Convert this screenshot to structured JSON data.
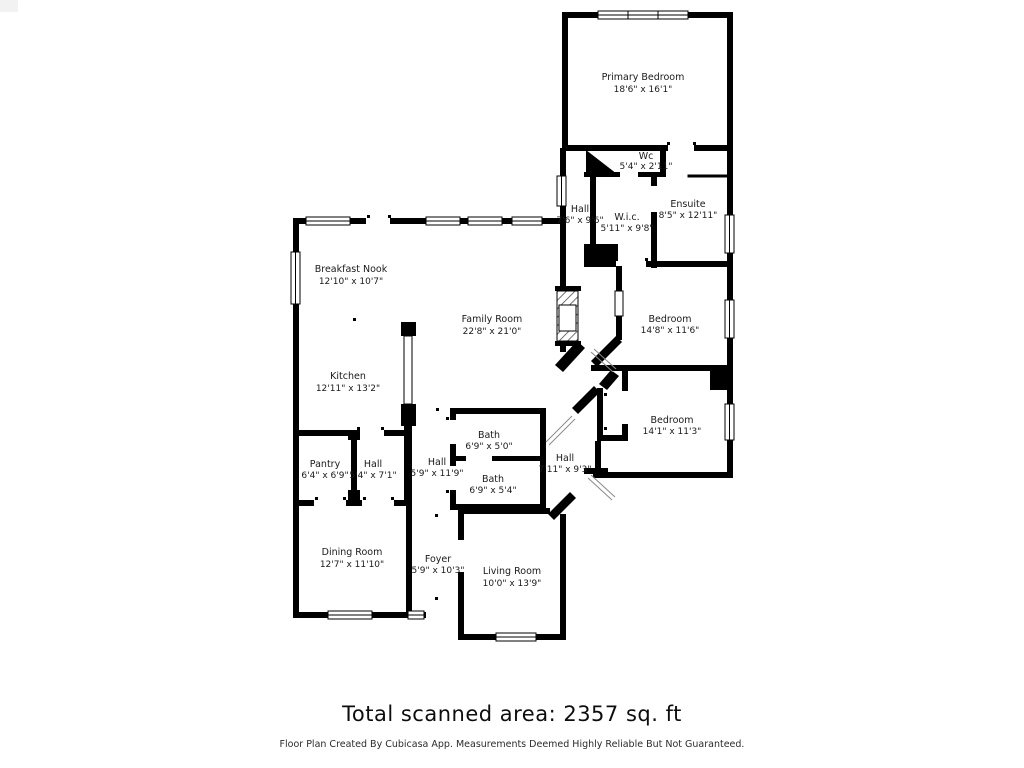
{
  "footer": {
    "total_area": "Total scanned area: 2357 sq. ft",
    "disclaimer": "Floor Plan Created By Cubicasa App. Measurements Deemed Highly Reliable But Not Guaranteed."
  },
  "rooms": [
    {
      "name": "Primary Bedroom",
      "dims": "18'6\" x 16'1\""
    },
    {
      "name": "Wc",
      "dims": "5'4\" x 2'11\""
    },
    {
      "name": "Hall",
      "dims": "7'6\" x 9'6\""
    },
    {
      "name": "W.i.c.",
      "dims": "5'11\" x 9'8\""
    },
    {
      "name": "Ensuite",
      "dims": "8'5\" x 12'11\""
    },
    {
      "name": "Breakfast Nook",
      "dims": "12'10\" x 10'7\""
    },
    {
      "name": "Family Room",
      "dims": "22'8\" x 21'0\""
    },
    {
      "name": "Kitchen",
      "dims": "12'11\" x 13'2\""
    },
    {
      "name": "Bedroom",
      "dims": "14'8\" x 11'6\""
    },
    {
      "name": "Bedroom",
      "dims": "14'1\" x 11'3\""
    },
    {
      "name": "Bath",
      "dims": "6'9\" x 5'0\""
    },
    {
      "name": "Bath",
      "dims": "6'9\" x 5'4\""
    },
    {
      "name": "Hall",
      "dims": "5'9\" x 11'9\""
    },
    {
      "name": "Hall",
      "dims": "7'11\" x 9'3\""
    },
    {
      "name": "Pantry",
      "dims": "6'4\" x 6'9\""
    },
    {
      "name": "Hall",
      "dims": "5'4\" x 7'1\""
    },
    {
      "name": "Dining Room",
      "dims": "12'7\" x 11'10\""
    },
    {
      "name": "Foyer",
      "dims": "5'9\" x 10'3\""
    },
    {
      "name": "Living Room",
      "dims": "10'0\" x 13'9\""
    }
  ]
}
